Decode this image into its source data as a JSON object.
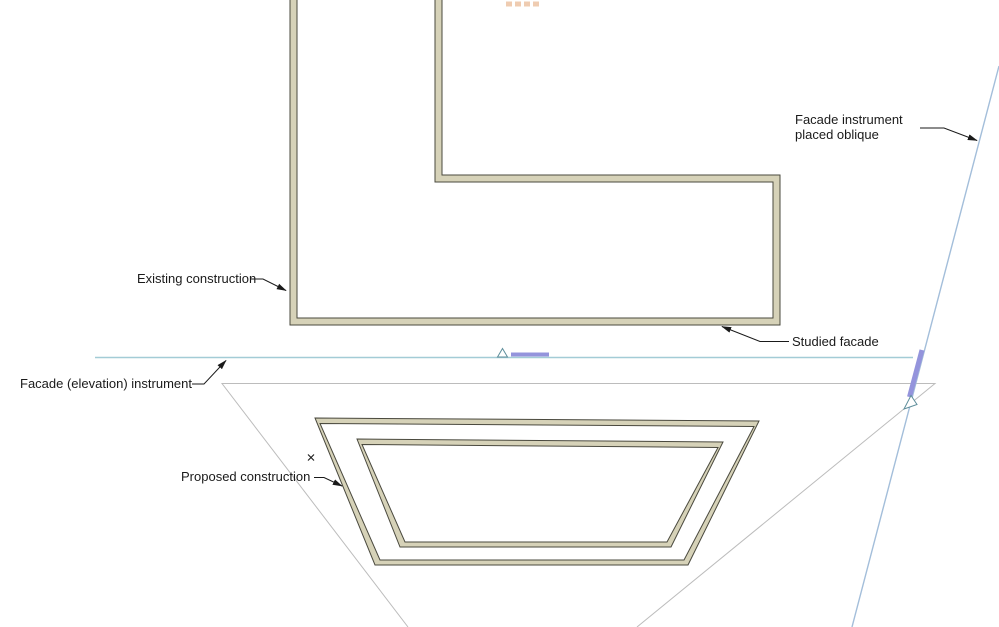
{
  "view": {
    "type": "cad-floor-plan",
    "description": "Plan view with existing L-shaped building, proposed trapezoid building, and two facade elevation instruments"
  },
  "colors": {
    "wallStroke": "#4a493e",
    "wallFill": "#d6d2b8",
    "coneStroke": "#bcbcbc",
    "elevationLine": "#a3ccd6",
    "obliqueLine": "#a3beda",
    "markerPurple": "#9494dc",
    "markerTriangleStroke": "#5e8e9b",
    "leaderStroke": "#1a1a1a",
    "labelColor": "#1a1a1a",
    "hotspotOrange": "#edc4a4"
  },
  "labels": {
    "existing_construction": "Existing construction",
    "studied_facade": "Studied facade",
    "facade_instrument_oblique": "Facade instrument placed oblique",
    "facade_elevation_instrument": "Facade (elevation) instrument",
    "proposed_construction": "Proposed construction"
  }
}
